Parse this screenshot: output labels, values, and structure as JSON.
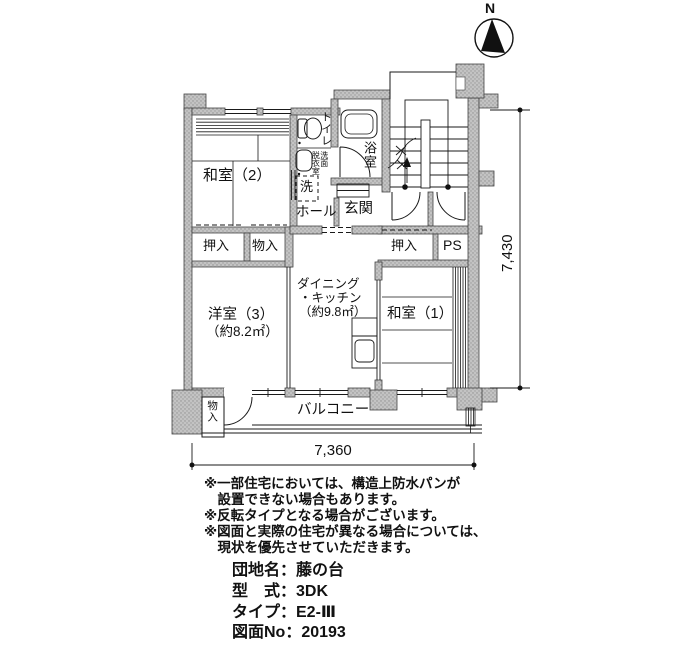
{
  "compass": {
    "north": "N"
  },
  "rooms": {
    "washitsu2": "和室（2）",
    "toilet": "トイレ",
    "washroom1": "洗面",
    "washroom2": "脱衣室",
    "washer": "洗",
    "bath": "浴室",
    "hall": "ホール",
    "entrance": "玄関",
    "closet_left": "押入",
    "storage_left": "物入",
    "closet_right": "押入",
    "pipe_space": "PS",
    "dk1": "ダイニング",
    "dk2": "・キッチン",
    "dk3": "（約9.8㎡）",
    "washitsu1": "和室（1）",
    "yoshitsu3": "洋室（3）",
    "yoshitsu3_area": "（約8.2㎡）",
    "storage_balcony": "物入",
    "balcony": "バルコニー"
  },
  "dimensions": {
    "horizontal": "7,360",
    "vertical": "7,430"
  },
  "notes": [
    "※一部住宅においては、構造上防水パンが",
    "　設置できない場合もあります。",
    "※反転タイプとなる場合がございます。",
    "※図面と実際の住宅が異なる場合については、",
    "　現状を優先させていただきます。"
  ],
  "info": [
    "団地名：藤の台",
    "型　式：3DK",
    "タイプ：E2-Ⅲ",
    "図面No：20193"
  ],
  "colors": {
    "wall_fill": "#c3c3c3",
    "wall_dot": "#8f8f8f",
    "line": "#1a1a1a"
  }
}
